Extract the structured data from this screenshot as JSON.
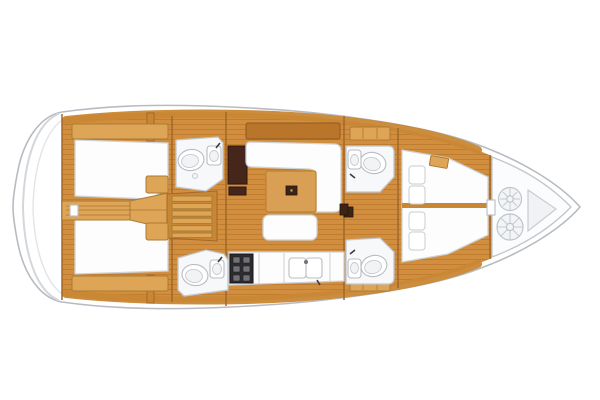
{
  "meta": {
    "title": "Sailing yacht interior layout - top-down floor plan",
    "view": "plan view, bow pointing right, stern at left",
    "diagram_type": "boat-floor-plan"
  },
  "colors": {
    "background": "#ffffff",
    "hull_fill": "#ffffff",
    "hull_outline": "#b7bbc1",
    "wood_floor": "#d18e3e",
    "wood_floor_stripe": "#c07c2f",
    "wood_trim": "#c98734",
    "wood_light": "#dfa557",
    "wood_dark": "#b9752a",
    "wood_table": "#d9a055",
    "furniture_white": "#fdfdfd",
    "head_floor": "#f7f8f9",
    "dark_cabinet": "#46261a",
    "stove_dark": "#2d2d30",
    "locker_fill": "#fbfcfd",
    "rope_gray": "#bfc4ca"
  },
  "areas": [
    {
      "id": "swim-platform",
      "label": "transom / swim platform with step lines"
    },
    {
      "id": "aft-cabin-port",
      "label": "aft double berth cabin (top)"
    },
    {
      "id": "aft-cabin-starboard",
      "label": "aft double berth cabin (bottom)"
    },
    {
      "id": "aft-head-port",
      "label": "aft head with toilet and sink (top)"
    },
    {
      "id": "aft-head-starboard",
      "label": "aft head with toilet and sink (bottom)"
    },
    {
      "id": "companionway",
      "label": "companionway steps between aft cabins"
    },
    {
      "id": "nav-cabinet",
      "label": "dark chart/nav cabinet beside salon"
    },
    {
      "id": "salon",
      "label": "salon with L-settee, wooden table and bench"
    },
    {
      "id": "galley",
      "label": "galley counter with stove and twin sinks"
    },
    {
      "id": "fwd-head-port",
      "label": "forward head (top)"
    },
    {
      "id": "fwd-head-starboard",
      "label": "forward head (bottom)"
    },
    {
      "id": "forward-cabin",
      "label": "forward V-berth cabin with pillows"
    },
    {
      "id": "anchor-locker",
      "label": "bow anchor locker with two rope coils"
    }
  ],
  "counts": {
    "cabins": 3,
    "heads": 4,
    "companionway_steps": 6,
    "stove_burners": 6,
    "berth_pillows": 4,
    "rope_coils": 2,
    "galley_sinks": 2
  }
}
